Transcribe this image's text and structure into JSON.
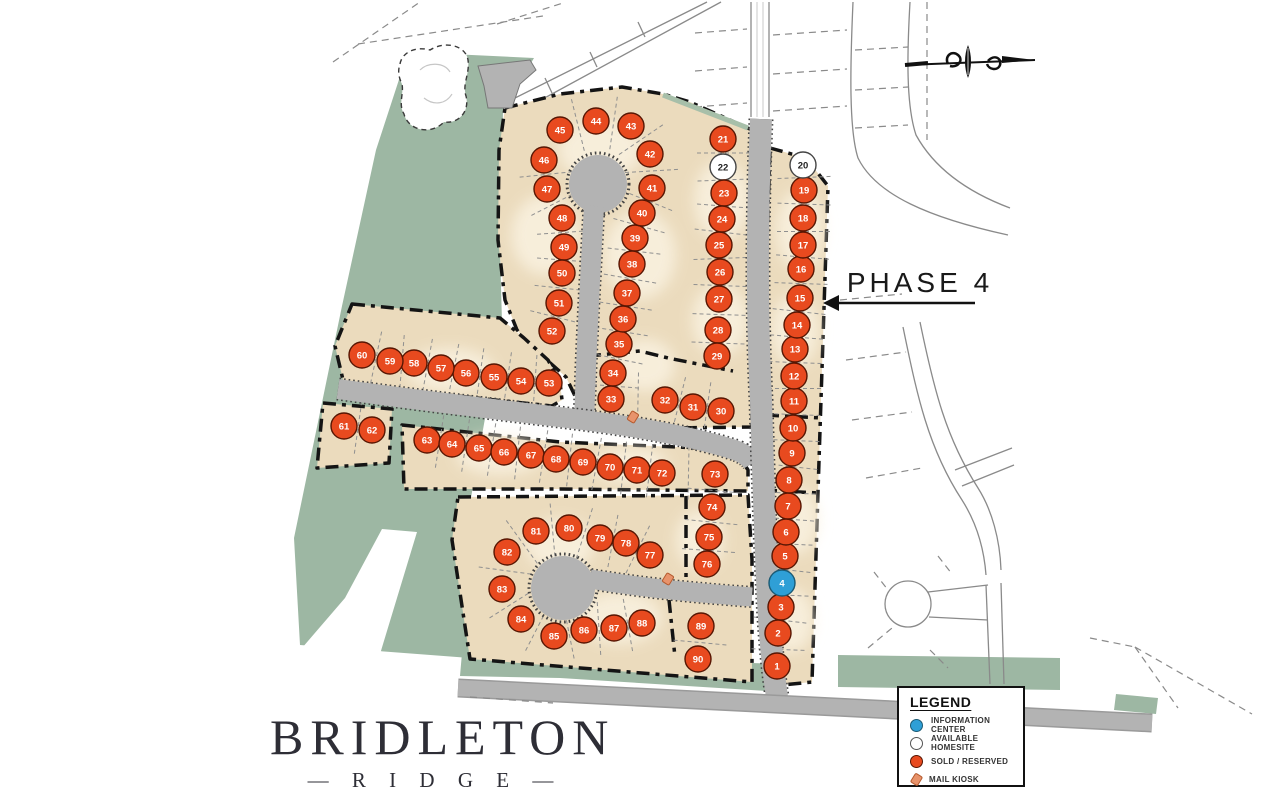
{
  "phase": {
    "label": "PHASE 4"
  },
  "logo": {
    "title": "BRIDLETON",
    "subtitle_display": "—  R I D G E  —"
  },
  "legend": {
    "title": "LEGEND",
    "items": [
      {
        "type": "info",
        "label": "INFORMATION CENTER"
      },
      {
        "type": "available",
        "label": "AVAILABLE HOMESITE"
      },
      {
        "type": "sold",
        "label": "SOLD / RESERVED"
      },
      {
        "type": "kiosk",
        "label": "MAIL KIOSK"
      }
    ]
  },
  "colors": {
    "sold": "#e84a1f",
    "sold_edge": "#571603",
    "available": "#ffffff",
    "available_edge": "#444444",
    "info": "#2f9fd6",
    "info_edge": "#1b5a74",
    "green": "#9db7a3",
    "tan": "#ebdbbd",
    "road": "#b3b3b3",
    "border": "#141414"
  },
  "kiosks": [
    {
      "x": 633,
      "y": 417
    },
    {
      "x": 668,
      "y": 579
    }
  ],
  "plat_rows": [
    [
      45,
      44,
      43,
      42,
      41,
      40,
      39,
      38,
      37,
      36,
      35,
      34,
      33
    ],
    [
      46,
      47,
      48,
      49,
      50,
      51,
      52
    ],
    [
      21,
      22,
      23,
      24,
      25,
      26,
      27,
      28,
      29
    ],
    [
      33,
      32,
      31,
      30
    ],
    [
      20,
      19,
      18,
      17,
      16,
      15,
      14,
      13,
      12,
      11,
      10,
      9,
      8,
      7,
      6,
      5,
      4,
      3,
      2,
      1
    ],
    [
      60,
      59,
      58,
      57,
      56,
      55,
      54,
      53
    ],
    [
      61,
      62
    ],
    [
      63,
      64,
      65,
      66,
      67,
      68,
      69,
      70,
      71,
      72
    ],
    [
      72,
      73
    ],
    [
      73,
      74
    ],
    [
      74,
      75,
      76
    ],
    [
      77,
      78,
      79,
      80,
      81,
      82,
      83,
      84,
      85
    ],
    [
      85,
      86,
      87,
      88
    ],
    [
      89,
      90
    ]
  ],
  "lots": [
    {
      "n": 1,
      "x": 777,
      "y": 666,
      "s": "sold"
    },
    {
      "n": 2,
      "x": 778,
      "y": 633,
      "s": "sold"
    },
    {
      "n": 3,
      "x": 781,
      "y": 607,
      "s": "sold"
    },
    {
      "n": 4,
      "x": 782,
      "y": 583,
      "s": "info"
    },
    {
      "n": 5,
      "x": 785,
      "y": 556,
      "s": "sold"
    },
    {
      "n": 6,
      "x": 786,
      "y": 532,
      "s": "sold"
    },
    {
      "n": 7,
      "x": 788,
      "y": 506,
      "s": "sold"
    },
    {
      "n": 8,
      "x": 789,
      "y": 480,
      "s": "sold"
    },
    {
      "n": 9,
      "x": 792,
      "y": 453,
      "s": "sold"
    },
    {
      "n": 10,
      "x": 793,
      "y": 428,
      "s": "sold"
    },
    {
      "n": 11,
      "x": 794,
      "y": 401,
      "s": "sold"
    },
    {
      "n": 12,
      "x": 794,
      "y": 376,
      "s": "sold"
    },
    {
      "n": 13,
      "x": 795,
      "y": 349,
      "s": "sold"
    },
    {
      "n": 14,
      "x": 797,
      "y": 325,
      "s": "sold"
    },
    {
      "n": 15,
      "x": 800,
      "y": 298,
      "s": "sold"
    },
    {
      "n": 16,
      "x": 801,
      "y": 269,
      "s": "sold"
    },
    {
      "n": 17,
      "x": 803,
      "y": 245,
      "s": "sold"
    },
    {
      "n": 18,
      "x": 803,
      "y": 218,
      "s": "sold"
    },
    {
      "n": 19,
      "x": 804,
      "y": 190,
      "s": "sold"
    },
    {
      "n": 20,
      "x": 803,
      "y": 165,
      "s": "available"
    },
    {
      "n": 21,
      "x": 723,
      "y": 139,
      "s": "sold"
    },
    {
      "n": 22,
      "x": 723,
      "y": 167,
      "s": "available"
    },
    {
      "n": 23,
      "x": 724,
      "y": 193,
      "s": "sold"
    },
    {
      "n": 24,
      "x": 722,
      "y": 219,
      "s": "sold"
    },
    {
      "n": 25,
      "x": 719,
      "y": 245,
      "s": "sold"
    },
    {
      "n": 26,
      "x": 720,
      "y": 272,
      "s": "sold"
    },
    {
      "n": 27,
      "x": 719,
      "y": 299,
      "s": "sold"
    },
    {
      "n": 28,
      "x": 718,
      "y": 330,
      "s": "sold"
    },
    {
      "n": 29,
      "x": 717,
      "y": 356,
      "s": "sold"
    },
    {
      "n": 30,
      "x": 721,
      "y": 411,
      "s": "sold"
    },
    {
      "n": 31,
      "x": 693,
      "y": 407,
      "s": "sold"
    },
    {
      "n": 32,
      "x": 665,
      "y": 400,
      "s": "sold"
    },
    {
      "n": 33,
      "x": 611,
      "y": 399,
      "s": "sold"
    },
    {
      "n": 34,
      "x": 613,
      "y": 373,
      "s": "sold"
    },
    {
      "n": 35,
      "x": 619,
      "y": 344,
      "s": "sold"
    },
    {
      "n": 36,
      "x": 623,
      "y": 319,
      "s": "sold"
    },
    {
      "n": 37,
      "x": 627,
      "y": 293,
      "s": "sold"
    },
    {
      "n": 38,
      "x": 632,
      "y": 264,
      "s": "sold"
    },
    {
      "n": 39,
      "x": 635,
      "y": 238,
      "s": "sold"
    },
    {
      "n": 40,
      "x": 642,
      "y": 213,
      "s": "sold"
    },
    {
      "n": 41,
      "x": 652,
      "y": 188,
      "s": "sold"
    },
    {
      "n": 42,
      "x": 650,
      "y": 154,
      "s": "sold"
    },
    {
      "n": 43,
      "x": 631,
      "y": 126,
      "s": "sold"
    },
    {
      "n": 44,
      "x": 596,
      "y": 121,
      "s": "sold"
    },
    {
      "n": 45,
      "x": 560,
      "y": 130,
      "s": "sold"
    },
    {
      "n": 46,
      "x": 544,
      "y": 160,
      "s": "sold"
    },
    {
      "n": 47,
      "x": 547,
      "y": 189,
      "s": "sold"
    },
    {
      "n": 48,
      "x": 562,
      "y": 218,
      "s": "sold"
    },
    {
      "n": 49,
      "x": 564,
      "y": 247,
      "s": "sold"
    },
    {
      "n": 50,
      "x": 562,
      "y": 273,
      "s": "sold"
    },
    {
      "n": 51,
      "x": 559,
      "y": 303,
      "s": "sold"
    },
    {
      "n": 52,
      "x": 552,
      "y": 331,
      "s": "sold"
    },
    {
      "n": 53,
      "x": 549,
      "y": 383,
      "s": "sold"
    },
    {
      "n": 54,
      "x": 521,
      "y": 381,
      "s": "sold"
    },
    {
      "n": 55,
      "x": 494,
      "y": 377,
      "s": "sold"
    },
    {
      "n": 56,
      "x": 466,
      "y": 373,
      "s": "sold"
    },
    {
      "n": 57,
      "x": 441,
      "y": 368,
      "s": "sold"
    },
    {
      "n": 58,
      "x": 414,
      "y": 363,
      "s": "sold"
    },
    {
      "n": 59,
      "x": 390,
      "y": 361,
      "s": "sold"
    },
    {
      "n": 60,
      "x": 362,
      "y": 355,
      "s": "sold"
    },
    {
      "n": 61,
      "x": 344,
      "y": 426,
      "s": "sold"
    },
    {
      "n": 62,
      "x": 372,
      "y": 430,
      "s": "sold"
    },
    {
      "n": 63,
      "x": 427,
      "y": 440,
      "s": "sold"
    },
    {
      "n": 64,
      "x": 452,
      "y": 444,
      "s": "sold"
    },
    {
      "n": 65,
      "x": 479,
      "y": 448,
      "s": "sold"
    },
    {
      "n": 66,
      "x": 504,
      "y": 452,
      "s": "sold"
    },
    {
      "n": 67,
      "x": 531,
      "y": 455,
      "s": "sold"
    },
    {
      "n": 68,
      "x": 556,
      "y": 459,
      "s": "sold"
    },
    {
      "n": 69,
      "x": 583,
      "y": 462,
      "s": "sold"
    },
    {
      "n": 70,
      "x": 610,
      "y": 467,
      "s": "sold"
    },
    {
      "n": 71,
      "x": 637,
      "y": 470,
      "s": "sold"
    },
    {
      "n": 72,
      "x": 662,
      "y": 473,
      "s": "sold"
    },
    {
      "n": 73,
      "x": 715,
      "y": 474,
      "s": "sold"
    },
    {
      "n": 74,
      "x": 712,
      "y": 507,
      "s": "sold"
    },
    {
      "n": 75,
      "x": 709,
      "y": 537,
      "s": "sold"
    },
    {
      "n": 76,
      "x": 707,
      "y": 564,
      "s": "sold"
    },
    {
      "n": 77,
      "x": 650,
      "y": 555,
      "s": "sold"
    },
    {
      "n": 78,
      "x": 626,
      "y": 543,
      "s": "sold"
    },
    {
      "n": 79,
      "x": 600,
      "y": 538,
      "s": "sold"
    },
    {
      "n": 80,
      "x": 569,
      "y": 528,
      "s": "sold"
    },
    {
      "n": 81,
      "x": 536,
      "y": 531,
      "s": "sold"
    },
    {
      "n": 82,
      "x": 507,
      "y": 552,
      "s": "sold"
    },
    {
      "n": 83,
      "x": 502,
      "y": 589,
      "s": "sold"
    },
    {
      "n": 84,
      "x": 521,
      "y": 619,
      "s": "sold"
    },
    {
      "n": 85,
      "x": 554,
      "y": 636,
      "s": "sold"
    },
    {
      "n": 86,
      "x": 584,
      "y": 630,
      "s": "sold"
    },
    {
      "n": 87,
      "x": 614,
      "y": 628,
      "s": "sold"
    },
    {
      "n": 88,
      "x": 642,
      "y": 623,
      "s": "sold"
    },
    {
      "n": 89,
      "x": 701,
      "y": 626,
      "s": "sold"
    },
    {
      "n": 90,
      "x": 698,
      "y": 659,
      "s": "sold"
    }
  ]
}
